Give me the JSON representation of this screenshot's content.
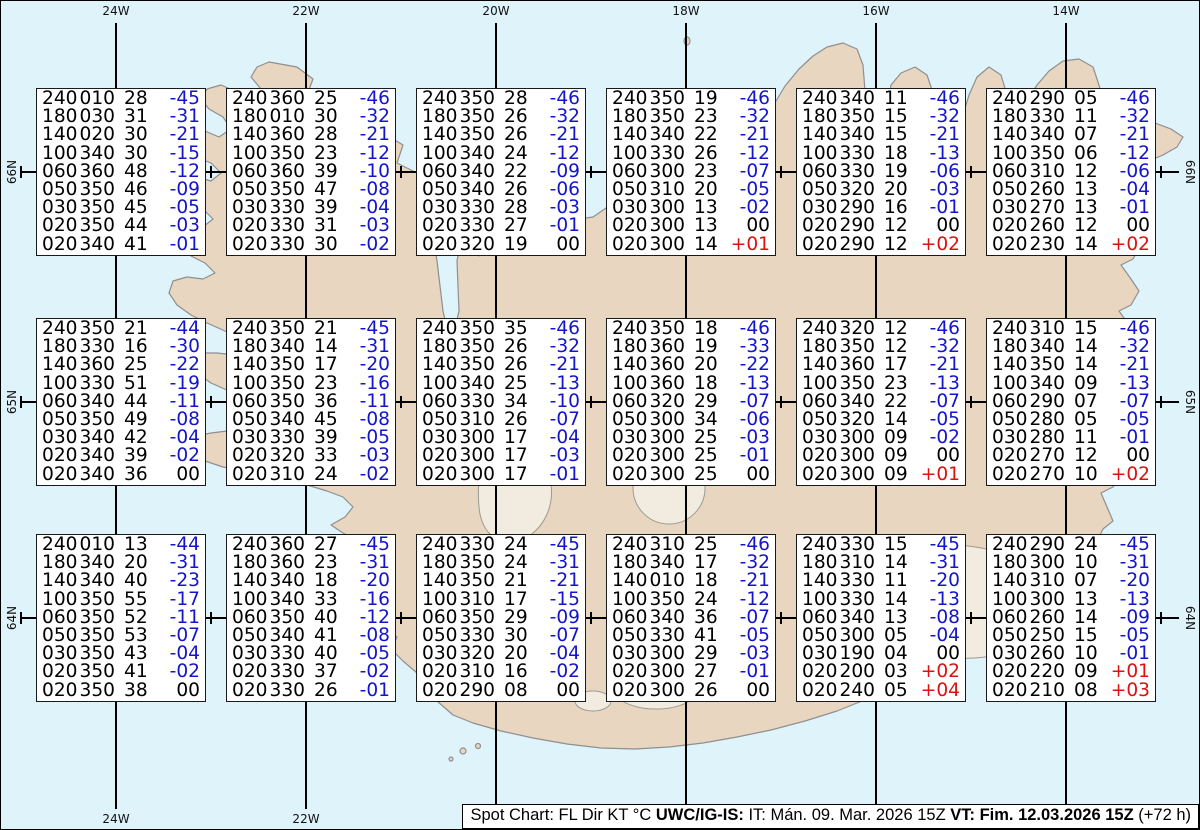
{
  "colors": {
    "ocean": "#def3fa",
    "land": "#e8d6c0",
    "coastline": "#8f8f8f",
    "glacier_fill": "#f2ebdf",
    "graticule": "#000000",
    "box_background": "#ffffff",
    "box_border": "#1a1a1a",
    "text_black": "#000000",
    "temp_negative": "#1414cc",
    "temp_zero": "#000000",
    "temp_positive": "#dd1111"
  },
  "graticule": {
    "meridians": [
      {
        "label": "24W",
        "x": 115
      },
      {
        "label": "22W",
        "x": 305
      },
      {
        "label": "20W",
        "x": 495
      },
      {
        "label": "18W",
        "x": 685
      },
      {
        "label": "16W",
        "x": 875
      },
      {
        "label": "14W",
        "x": 1065
      }
    ],
    "bottom_labels_visible": [
      "24W",
      "22W"
    ],
    "parallels": [
      {
        "label": "66N",
        "y": 171
      },
      {
        "label": "65N",
        "y": 401
      },
      {
        "label": "64N",
        "y": 617
      }
    ],
    "minor_tick_xs": [
      20,
      210,
      400,
      590,
      780,
      970,
      1160
    ]
  },
  "chart_data": {
    "type": "table",
    "title": "Spot Chart: FL Dir KT °C",
    "columns": [
      "FL",
      "Dir",
      "KT",
      "°C"
    ],
    "spots": [
      {
        "lat": "66N",
        "lon": "24W",
        "rows": [
          [
            "240",
            "010",
            "28",
            "-45"
          ],
          [
            "180",
            "030",
            "31",
            "-31"
          ],
          [
            "140",
            "020",
            "30",
            "-21"
          ],
          [
            "100",
            "340",
            "30",
            "-15"
          ],
          [
            "060",
            "360",
            "48",
            "-12"
          ],
          [
            "050",
            "350",
            "46",
            "-09"
          ],
          [
            "030",
            "350",
            "45",
            "-05"
          ],
          [
            "020",
            "350",
            "44",
            "-03"
          ],
          [
            "020",
            "340",
            "41",
            "-01"
          ]
        ]
      },
      {
        "lat": "66N",
        "lon": "22W",
        "rows": [
          [
            "240",
            "360",
            "25",
            "-46"
          ],
          [
            "180",
            "010",
            "30",
            "-32"
          ],
          [
            "140",
            "360",
            "28",
            "-21"
          ],
          [
            "100",
            "350",
            "23",
            "-12"
          ],
          [
            "060",
            "360",
            "39",
            "-10"
          ],
          [
            "050",
            "350",
            "47",
            "-08"
          ],
          [
            "030",
            "330",
            "39",
            "-04"
          ],
          [
            "020",
            "330",
            "31",
            "-03"
          ],
          [
            "020",
            "330",
            "30",
            "-02"
          ]
        ]
      },
      {
        "lat": "66N",
        "lon": "20W",
        "rows": [
          [
            "240",
            "350",
            "28",
            "-46"
          ],
          [
            "180",
            "350",
            "26",
            "-32"
          ],
          [
            "140",
            "350",
            "26",
            "-21"
          ],
          [
            "100",
            "340",
            "24",
            "-12"
          ],
          [
            "060",
            "340",
            "22",
            "-09"
          ],
          [
            "050",
            "340",
            "26",
            "-06"
          ],
          [
            "030",
            "330",
            "28",
            "-03"
          ],
          [
            "020",
            "330",
            "27",
            "-01"
          ],
          [
            "020",
            "320",
            "19",
            "00"
          ]
        ]
      },
      {
        "lat": "66N",
        "lon": "18W",
        "rows": [
          [
            "240",
            "350",
            "19",
            "-46"
          ],
          [
            "180",
            "350",
            "23",
            "-32"
          ],
          [
            "140",
            "340",
            "22",
            "-21"
          ],
          [
            "100",
            "330",
            "26",
            "-12"
          ],
          [
            "060",
            "300",
            "23",
            "-07"
          ],
          [
            "050",
            "310",
            "20",
            "-05"
          ],
          [
            "030",
            "300",
            "13",
            "-02"
          ],
          [
            "020",
            "300",
            "13",
            "00"
          ],
          [
            "020",
            "300",
            "14",
            "+01"
          ]
        ]
      },
      {
        "lat": "66N",
        "lon": "16W",
        "rows": [
          [
            "240",
            "340",
            "11",
            "-46"
          ],
          [
            "180",
            "350",
            "15",
            "-32"
          ],
          [
            "140",
            "340",
            "15",
            "-21"
          ],
          [
            "100",
            "330",
            "18",
            "-13"
          ],
          [
            "060",
            "330",
            "19",
            "-06"
          ],
          [
            "050",
            "320",
            "20",
            "-03"
          ],
          [
            "030",
            "290",
            "16",
            "-01"
          ],
          [
            "020",
            "290",
            "12",
            "00"
          ],
          [
            "020",
            "290",
            "12",
            "+02"
          ]
        ]
      },
      {
        "lat": "66N",
        "lon": "14W",
        "rows": [
          [
            "240",
            "290",
            "05",
            "-46"
          ],
          [
            "180",
            "330",
            "11",
            "-32"
          ],
          [
            "140",
            "340",
            "07",
            "-21"
          ],
          [
            "100",
            "350",
            "06",
            "-12"
          ],
          [
            "060",
            "310",
            "12",
            "-06"
          ],
          [
            "050",
            "260",
            "13",
            "-04"
          ],
          [
            "030",
            "270",
            "13",
            "-01"
          ],
          [
            "020",
            "260",
            "12",
            "00"
          ],
          [
            "020",
            "230",
            "14",
            "+02"
          ]
        ]
      },
      {
        "lat": "65N",
        "lon": "24W",
        "rows": [
          [
            "240",
            "350",
            "21",
            "-44"
          ],
          [
            "180",
            "330",
            "16",
            "-30"
          ],
          [
            "140",
            "360",
            "25",
            "-22"
          ],
          [
            "100",
            "330",
            "51",
            "-19"
          ],
          [
            "060",
            "340",
            "44",
            "-11"
          ],
          [
            "050",
            "350",
            "49",
            "-08"
          ],
          [
            "030",
            "340",
            "42",
            "-04"
          ],
          [
            "020",
            "340",
            "39",
            "-02"
          ],
          [
            "020",
            "340",
            "36",
            "00"
          ]
        ]
      },
      {
        "lat": "65N",
        "lon": "22W",
        "rows": [
          [
            "240",
            "350",
            "21",
            "-45"
          ],
          [
            "180",
            "340",
            "14",
            "-31"
          ],
          [
            "140",
            "350",
            "17",
            "-20"
          ],
          [
            "100",
            "350",
            "23",
            "-16"
          ],
          [
            "060",
            "350",
            "36",
            "-11"
          ],
          [
            "050",
            "340",
            "45",
            "-08"
          ],
          [
            "030",
            "330",
            "39",
            "-05"
          ],
          [
            "020",
            "320",
            "33",
            "-03"
          ],
          [
            "020",
            "310",
            "24",
            "-02"
          ]
        ]
      },
      {
        "lat": "65N",
        "lon": "20W",
        "rows": [
          [
            "240",
            "350",
            "35",
            "-46"
          ],
          [
            "180",
            "350",
            "26",
            "-32"
          ],
          [
            "140",
            "350",
            "26",
            "-21"
          ],
          [
            "100",
            "340",
            "25",
            "-13"
          ],
          [
            "060",
            "330",
            "34",
            "-10"
          ],
          [
            "050",
            "310",
            "26",
            "-07"
          ],
          [
            "030",
            "300",
            "17",
            "-04"
          ],
          [
            "020",
            "300",
            "17",
            "-03"
          ],
          [
            "020",
            "300",
            "17",
            "-01"
          ]
        ]
      },
      {
        "lat": "65N",
        "lon": "18W",
        "rows": [
          [
            "240",
            "350",
            "18",
            "-46"
          ],
          [
            "180",
            "360",
            "19",
            "-33"
          ],
          [
            "140",
            "360",
            "20",
            "-22"
          ],
          [
            "100",
            "360",
            "18",
            "-13"
          ],
          [
            "060",
            "320",
            "29",
            "-07"
          ],
          [
            "050",
            "300",
            "34",
            "-06"
          ],
          [
            "030",
            "300",
            "25",
            "-03"
          ],
          [
            "020",
            "300",
            "25",
            "-01"
          ],
          [
            "020",
            "300",
            "25",
            "00"
          ]
        ]
      },
      {
        "lat": "65N",
        "lon": "16W",
        "rows": [
          [
            "240",
            "320",
            "12",
            "-46"
          ],
          [
            "180",
            "350",
            "12",
            "-32"
          ],
          [
            "140",
            "360",
            "17",
            "-21"
          ],
          [
            "100",
            "350",
            "23",
            "-13"
          ],
          [
            "060",
            "340",
            "22",
            "-07"
          ],
          [
            "050",
            "320",
            "14",
            "-05"
          ],
          [
            "030",
            "300",
            "09",
            "-02"
          ],
          [
            "020",
            "300",
            "09",
            "00"
          ],
          [
            "020",
            "300",
            "09",
            "+01"
          ]
        ]
      },
      {
        "lat": "65N",
        "lon": "14W",
        "rows": [
          [
            "240",
            "310",
            "15",
            "-46"
          ],
          [
            "180",
            "340",
            "14",
            "-32"
          ],
          [
            "140",
            "350",
            "14",
            "-21"
          ],
          [
            "100",
            "340",
            "09",
            "-13"
          ],
          [
            "060",
            "290",
            "07",
            "-07"
          ],
          [
            "050",
            "280",
            "05",
            "-05"
          ],
          [
            "030",
            "280",
            "11",
            "-01"
          ],
          [
            "020",
            "270",
            "12",
            "00"
          ],
          [
            "020",
            "270",
            "10",
            "+02"
          ]
        ]
      },
      {
        "lat": "64N",
        "lon": "24W",
        "rows": [
          [
            "240",
            "010",
            "13",
            "-44"
          ],
          [
            "180",
            "340",
            "20",
            "-31"
          ],
          [
            "140",
            "340",
            "40",
            "-23"
          ],
          [
            "100",
            "350",
            "55",
            "-17"
          ],
          [
            "060",
            "350",
            "52",
            "-11"
          ],
          [
            "050",
            "350",
            "53",
            "-07"
          ],
          [
            "030",
            "350",
            "43",
            "-04"
          ],
          [
            "020",
            "350",
            "41",
            "-02"
          ],
          [
            "020",
            "350",
            "38",
            "00"
          ]
        ]
      },
      {
        "lat": "64N",
        "lon": "22W",
        "rows": [
          [
            "240",
            "360",
            "27",
            "-45"
          ],
          [
            "180",
            "360",
            "23",
            "-31"
          ],
          [
            "140",
            "340",
            "18",
            "-20"
          ],
          [
            "100",
            "340",
            "33",
            "-16"
          ],
          [
            "060",
            "350",
            "40",
            "-12"
          ],
          [
            "050",
            "340",
            "41",
            "-08"
          ],
          [
            "030",
            "330",
            "40",
            "-05"
          ],
          [
            "020",
            "330",
            "37",
            "-02"
          ],
          [
            "020",
            "330",
            "26",
            "-01"
          ]
        ]
      },
      {
        "lat": "64N",
        "lon": "20W",
        "rows": [
          [
            "240",
            "330",
            "24",
            "-45"
          ],
          [
            "180",
            "350",
            "24",
            "-31"
          ],
          [
            "140",
            "350",
            "21",
            "-21"
          ],
          [
            "100",
            "310",
            "17",
            "-15"
          ],
          [
            "060",
            "350",
            "29",
            "-09"
          ],
          [
            "050",
            "330",
            "30",
            "-07"
          ],
          [
            "030",
            "320",
            "20",
            "-04"
          ],
          [
            "020",
            "310",
            "16",
            "-02"
          ],
          [
            "020",
            "290",
            "08",
            "00"
          ]
        ]
      },
      {
        "lat": "64N",
        "lon": "18W",
        "rows": [
          [
            "240",
            "310",
            "25",
            "-46"
          ],
          [
            "180",
            "340",
            "17",
            "-32"
          ],
          [
            "140",
            "010",
            "18",
            "-21"
          ],
          [
            "100",
            "350",
            "24",
            "-12"
          ],
          [
            "060",
            "340",
            "36",
            "-07"
          ],
          [
            "050",
            "330",
            "41",
            "-05"
          ],
          [
            "030",
            "300",
            "29",
            "-03"
          ],
          [
            "020",
            "300",
            "27",
            "-01"
          ],
          [
            "020",
            "300",
            "26",
            "00"
          ]
        ]
      },
      {
        "lat": "64N",
        "lon": "16W",
        "rows": [
          [
            "240",
            "330",
            "15",
            "-45"
          ],
          [
            "180",
            "310",
            "14",
            "-31"
          ],
          [
            "140",
            "330",
            "11",
            "-20"
          ],
          [
            "100",
            "330",
            "14",
            "-13"
          ],
          [
            "060",
            "340",
            "13",
            "-08"
          ],
          [
            "050",
            "300",
            "05",
            "-04"
          ],
          [
            "030",
            "190",
            "04",
            "00"
          ],
          [
            "020",
            "200",
            "03",
            "+02"
          ],
          [
            "020",
            "240",
            "05",
            "+04"
          ]
        ]
      },
      {
        "lat": "64N",
        "lon": "14W",
        "rows": [
          [
            "240",
            "290",
            "24",
            "-45"
          ],
          [
            "180",
            "300",
            "10",
            "-31"
          ],
          [
            "140",
            "310",
            "07",
            "-20"
          ],
          [
            "100",
            "300",
            "13",
            "-13"
          ],
          [
            "060",
            "260",
            "14",
            "-09"
          ],
          [
            "050",
            "250",
            "15",
            "-05"
          ],
          [
            "030",
            "260",
            "10",
            "-01"
          ],
          [
            "020",
            "220",
            "09",
            "+01"
          ],
          [
            "020",
            "210",
            "08",
            "+03"
          ]
        ]
      }
    ]
  },
  "caption": {
    "segments": [
      {
        "text": "Spot Chart: FL Dir KT °C ",
        "bold": false
      },
      {
        "text": "UWC/IG-IS:",
        "bold": true
      },
      {
        "text": " IT: Mán. 09. Mar. 2026 15Z ",
        "bold": false
      },
      {
        "text": "VT: Fim. 12.03.2026 15Z",
        "bold": true
      },
      {
        "text": " (+72 h)",
        "bold": false
      }
    ]
  }
}
